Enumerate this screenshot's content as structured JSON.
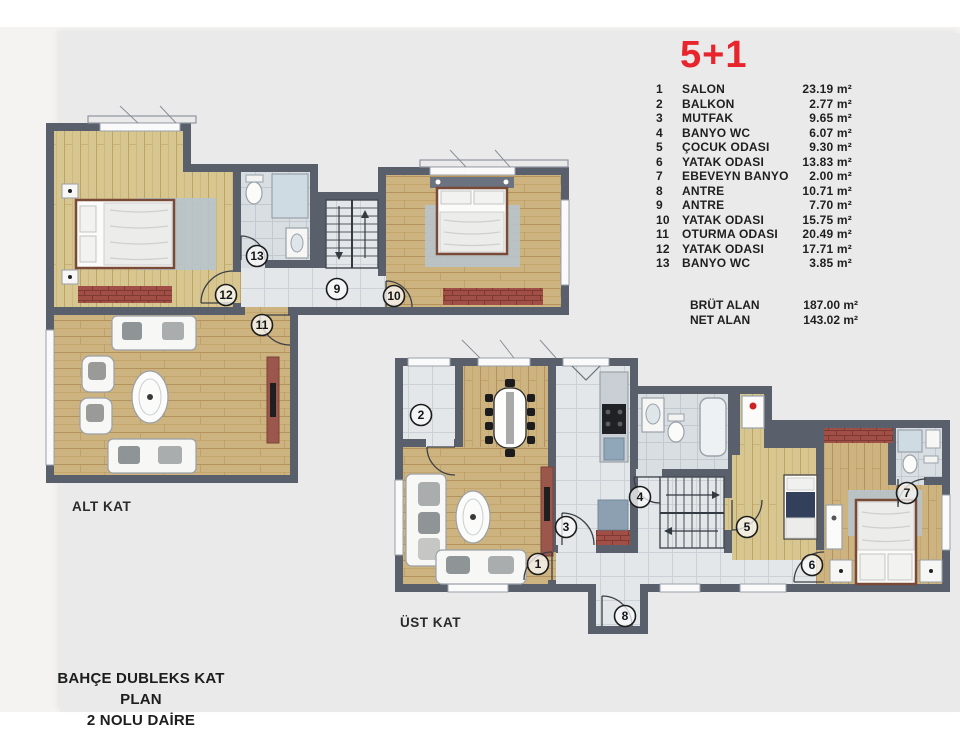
{
  "title": {
    "text": "5+1",
    "color": "#e8252c"
  },
  "legend": {
    "items": [
      {
        "num": "1",
        "name": "SALON",
        "area": "23.19 m²"
      },
      {
        "num": "2",
        "name": "BALKON",
        "area": "2.77 m²"
      },
      {
        "num": "3",
        "name": "MUTFAK",
        "area": "9.65 m²"
      },
      {
        "num": "4",
        "name": "BANYO WC",
        "area": "6.07 m²"
      },
      {
        "num": "5",
        "name": "ÇOCUK ODASI",
        "area": "9.30 m²"
      },
      {
        "num": "6",
        "name": "YATAK ODASI",
        "area": "13.83 m²"
      },
      {
        "num": "7",
        "name": "EBEVEYN BANYO",
        "area": "2.00 m²"
      },
      {
        "num": "8",
        "name": "ANTRE",
        "area": "10.71 m²"
      },
      {
        "num": "9",
        "name": "ANTRE",
        "area": "7.70 m²"
      },
      {
        "num": "10",
        "name": "YATAK ODASI",
        "area": "15.75 m²"
      },
      {
        "num": "11",
        "name": "OTURMA ODASI",
        "area": "20.49 m²"
      },
      {
        "num": "12",
        "name": "YATAK ODASI",
        "area": "17.71 m²"
      },
      {
        "num": "13",
        "name": "BANYO WC",
        "area": "3.85 m²"
      }
    ],
    "totals": [
      {
        "label": "BRÜT ALAN",
        "value": "187.00 m²"
      },
      {
        "label": "NET ALAN",
        "value": "143.02 m²"
      }
    ]
  },
  "floors": {
    "lower_label": "ALT KAT",
    "upper_label": "ÜST KAT"
  },
  "caption": {
    "line1": "BAHÇE DUBLEKS  KAT PLAN",
    "line2": "2 NOLU DAİRE"
  },
  "markers": {
    "alt": [
      {
        "n": "13"
      },
      {
        "n": "12"
      },
      {
        "n": "9"
      },
      {
        "n": "10"
      },
      {
        "n": "11"
      }
    ],
    "ust": [
      {
        "n": "2"
      },
      {
        "n": "1"
      },
      {
        "n": "3"
      },
      {
        "n": "4"
      },
      {
        "n": "5"
      },
      {
        "n": "6"
      },
      {
        "n": "7"
      },
      {
        "n": "8"
      }
    ]
  },
  "colors": {
    "accent_red": "#e8252c",
    "wall": "#5a5f6c",
    "wood": "#cdb37f",
    "tile": "#e4e7ea",
    "brick": "#a14f46",
    "panel": "#ebeaea"
  }
}
